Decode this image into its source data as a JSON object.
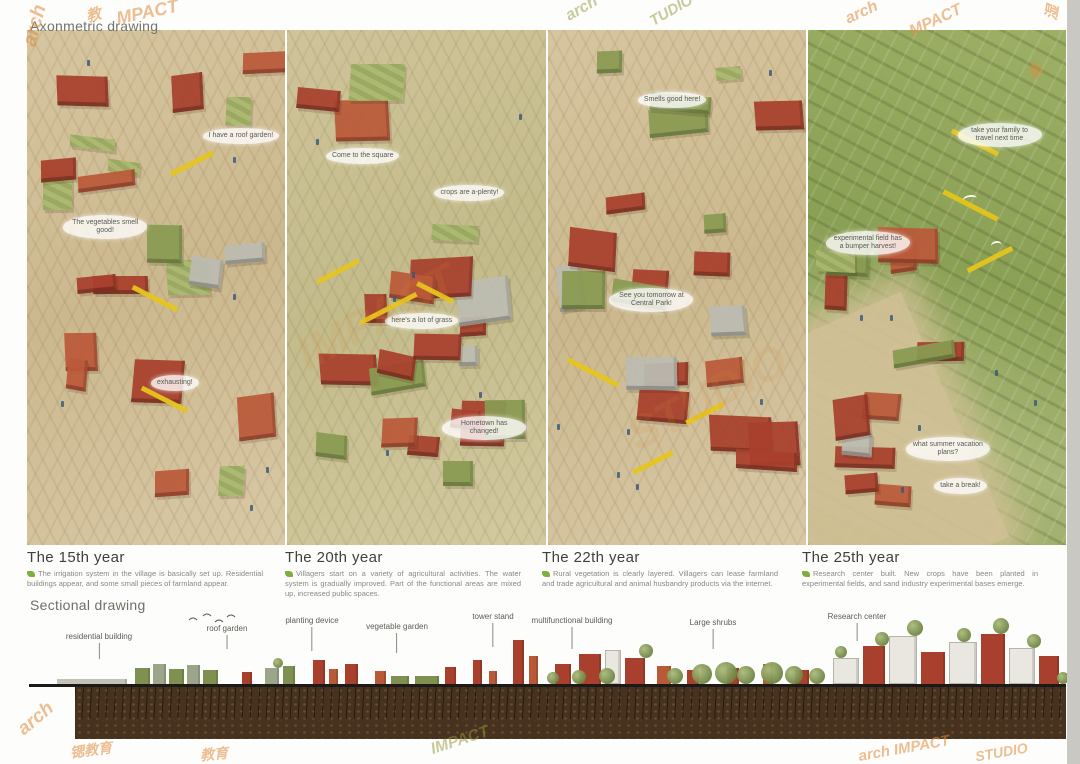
{
  "page": {
    "axon_title": "Axonmetric drawing",
    "section_title": "Sectional drawing"
  },
  "panels": [
    {
      "title": "The 15th year",
      "description": "The irrigation system in the village is basically set up. Residential buildings appear, and some small pieces of farmland appear.",
      "bubbles": [
        "I have a roof garden!",
        "The vegetables smell good!",
        "exhausting!"
      ]
    },
    {
      "title": "The 20th year",
      "description": "Villagers start on a variety of agricultural activities. The water system is gradually improved. Part of the functional areas are mixed up, increased public spaces.",
      "bubbles": [
        "Come to the square",
        "crops are a-plenty!",
        "here's a lot of grass",
        "Hometown has changed!"
      ]
    },
    {
      "title": "The 22th year",
      "description": "Rural vegetation is clearly layered. Villagers can lease farmland and trade agricultural and animal husbandry products via the internet.",
      "bubbles": [
        "Smells good here!",
        "See you tomorrow at Central Park!"
      ]
    },
    {
      "title": "The 25th year",
      "description": "Research center built. New crops have been planted in experimental fields, and sand industry experimental bases emerge.",
      "bubbles": [
        "take your family to travel next time",
        "experimental field has a bumper harvest!",
        "what summer vacation plans?",
        "take a break!"
      ]
    }
  ],
  "section": {
    "labels": [
      "residential building",
      "roof garden",
      "planting device",
      "vegetable garden",
      "tower stand",
      "multifunctional building",
      "Large shrubs",
      "Research center"
    ]
  },
  "watermark": {
    "items": [
      "arch",
      "教",
      "MPACT",
      "arch",
      "TUDIO",
      "arch",
      "MPACT",
      "湿",
      "锶",
      "arch",
      "锶教育",
      "IMPACT",
      "教育",
      "arch IMPACT",
      "STUDIO",
      "IMPACT",
      "STUDIO"
    ]
  },
  "colors": {
    "brick": "#a8402d",
    "vegetation": "#8a9b52",
    "ground": "#d2c098",
    "field_green": "#8ea556",
    "accent_yellow": "#e6c51c",
    "watermark_orange": "#e08b3c",
    "soil": "#46321f"
  }
}
